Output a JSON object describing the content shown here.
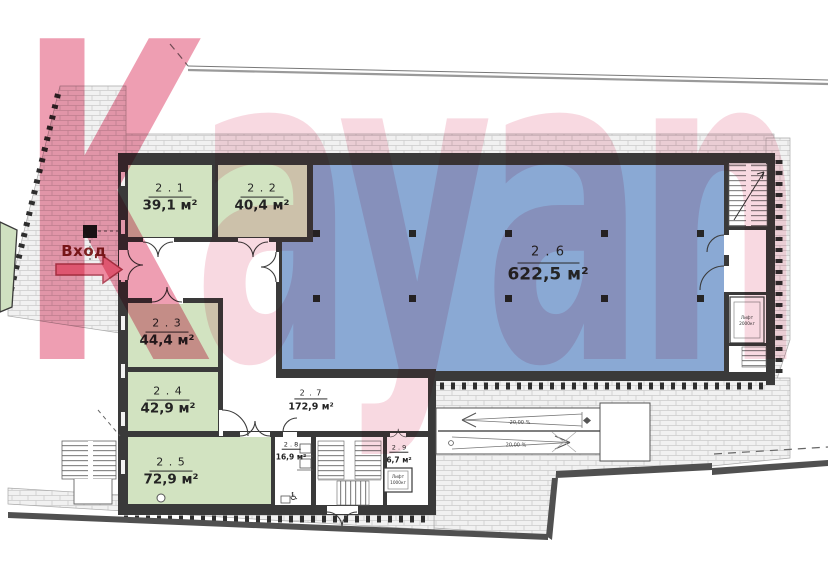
{
  "watermark": {
    "text": "Kayan"
  },
  "entrance": {
    "label": "Вход"
  },
  "rooms": {
    "r21": {
      "number": "2 . 1",
      "area": "39,1 м²"
    },
    "r22": {
      "number": "2 . 2",
      "area": "40,4 м²"
    },
    "r23": {
      "number": "2 . 3",
      "area": "44,4 м²"
    },
    "r24": {
      "number": "2 . 4",
      "area": "42,9 м²"
    },
    "r25": {
      "number": "2 . 5",
      "area": "72,9 м²"
    },
    "r26": {
      "number": "2 . 6",
      "area": "622,5 м²"
    },
    "r27": {
      "number": "2 . 7",
      "area": "172,9 м²"
    },
    "r28": {
      "number": "2 . 8",
      "area": "16,9 м²"
    },
    "r29": {
      "number": "2 . 9",
      "area": "6,7 м²"
    }
  },
  "ramp": {
    "lane1_slope": "20,00 %",
    "lane2_slope": "20,00 %"
  },
  "lifts": {
    "center": {
      "line1": "Лифт",
      "line2": "1000кг"
    },
    "right": {
      "line1": "Лифт",
      "line2": "2000кг"
    }
  },
  "symbols": {
    "accessible_wc": "♿"
  },
  "colors": {
    "room_green": "#d2e3c1",
    "room_blue": "#8aa9d4",
    "watermark_pink": "#ef9db4",
    "entrance_red": "#7e2222",
    "arrow_pink": "#ee8aa0",
    "wall_dark": "#3a3a3a",
    "paving_gray": "#f1f1f1"
  }
}
